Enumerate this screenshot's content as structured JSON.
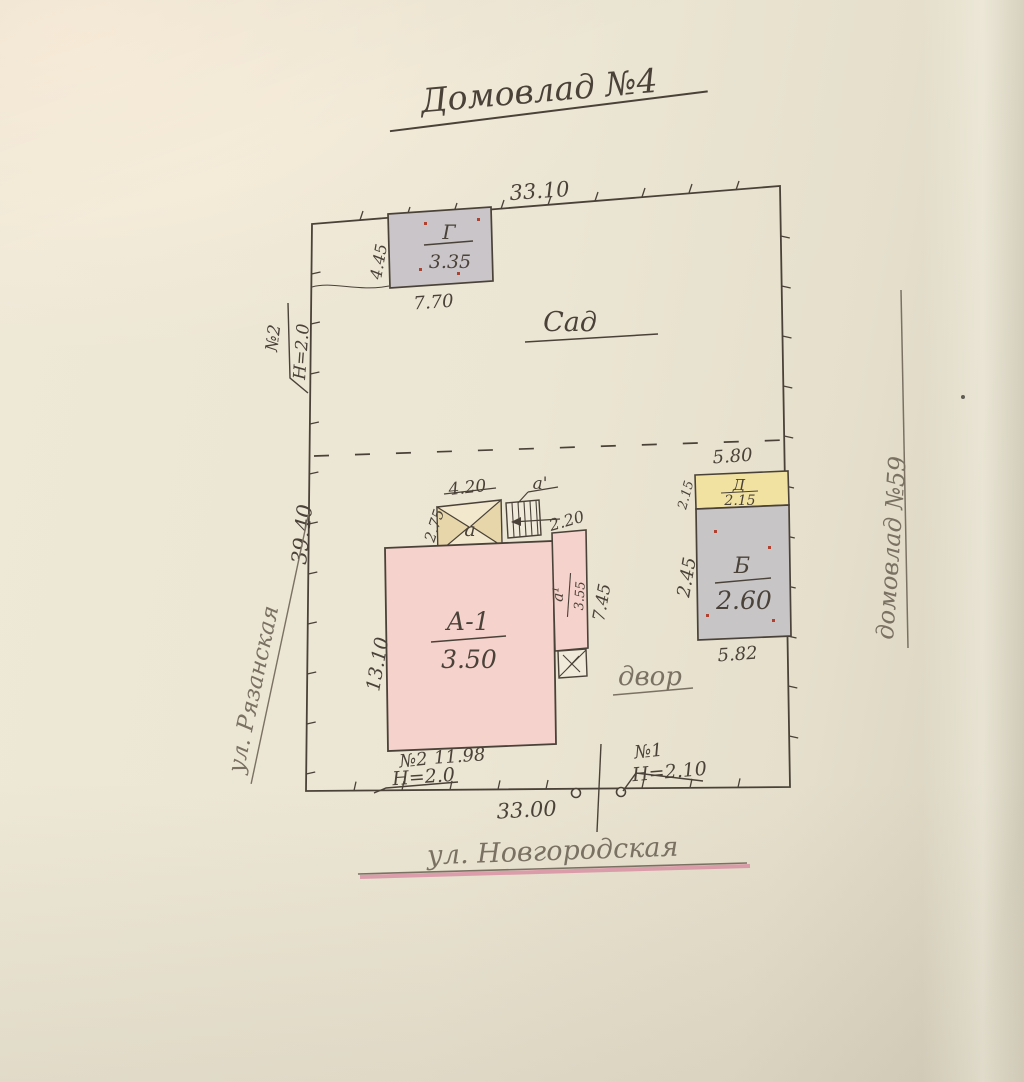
{
  "title": "Домовлад №4",
  "plot": {
    "dim_top": "33.10",
    "dim_bottom": "33.00",
    "dim_left": "39.40",
    "area_garden": "Сад",
    "area_yard": "двор",
    "street_left": "ул. Рязанская",
    "street_bottom": "ул. Новгородская",
    "neighbor_right": "домовлад №59"
  },
  "buildings": {
    "g": {
      "letter": "Г",
      "height": "3.35",
      "dim_bottom": "7.70",
      "dim_left": "4.45"
    },
    "a1": {
      "letter": "А-1",
      "height": "3.50",
      "dim_bottom": "11.98",
      "dim_left": "13.10"
    },
    "porch": {
      "letter": "а",
      "dim_top": "4.20",
      "dim_left": "2.75"
    },
    "stairs": {
      "letter": "а'"
    },
    "ext": {
      "letter": "а¹",
      "height": "3.55",
      "dim_right": "7.45",
      "dim_top": "2.20"
    },
    "b": {
      "letter": "Б",
      "height": "2.60",
      "dim_top": "5.80",
      "dim_bottom": "5.82",
      "dim_left": "2.45"
    },
    "d": {
      "letter": "Д",
      "height": "2.15",
      "dim_left": "2.15"
    }
  },
  "fences": {
    "left": {
      "num": "№2",
      "h": "Н=2.0"
    },
    "bottom_left": {
      "num": "№2",
      "h": "Н=2.0"
    },
    "bottom_right": {
      "num": "№1",
      "h": "Н=2.10"
    }
  },
  "colors": {
    "ink": "#4a4238",
    "pencil": "#7a7163",
    "pink_building": "#f5d2cb",
    "gray_building": "#c9c5c8",
    "yellow_building": "#f1e2a2",
    "tan_porch": "#e7d6a9",
    "street_underline_pink": "#d46f92",
    "red_dots": "#b0402f"
  }
}
